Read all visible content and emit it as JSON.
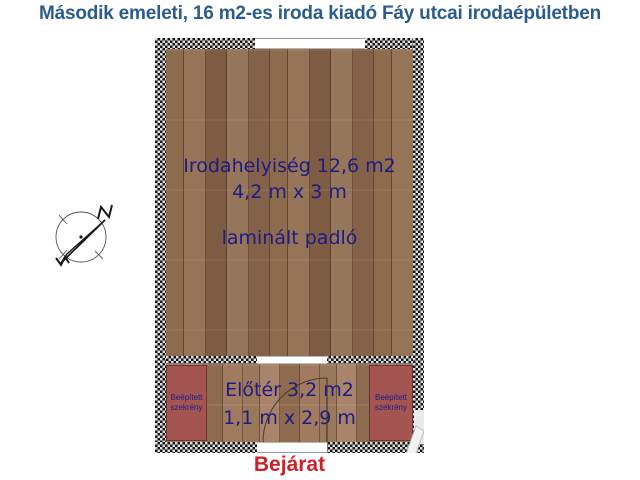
{
  "title": "Második emeleti, 16 m2-es iroda kiadó Fáy utcai irodaépületben",
  "floorplan": {
    "office": {
      "label": "Irodahelyiség 12,6 m2",
      "dimensions": "4,2 m x 3 m",
      "flooring": "laminált padló"
    },
    "foyer": {
      "label": "Előtér 3,2 m2",
      "dimensions": "1,1 m x 2,9 m"
    },
    "wardrobes": [
      {
        "label": "Beépített szekrény"
      },
      {
        "label": "Beépített szekrény"
      }
    ],
    "entrance_label": "Bejárat"
  },
  "icons": {
    "compass": "north-arrow"
  },
  "colors": {
    "title_text": "#2b5c8c",
    "room_text": "#1e1b84",
    "entrance_text": "#cc2128",
    "wardrobe_fill": "#a45552",
    "wall_dark": "#161616",
    "wall_light": "#dedede",
    "wood_base": "#8d6b4d"
  }
}
